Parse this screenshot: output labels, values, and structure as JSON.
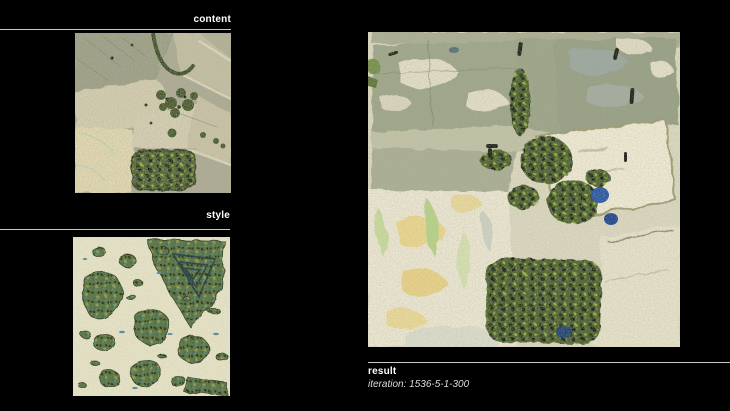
{
  "window": {
    "width": 730,
    "height": 411,
    "background": "#000000"
  },
  "sections": {
    "content": {
      "label": "content",
      "image_alt": "aerial farmland content image"
    },
    "style": {
      "label": "style",
      "image_alt": "painted map islands style image"
    },
    "result": {
      "label": "result",
      "iteration": "iteration: 1536-5-1-300",
      "image_alt": "style transfer result image"
    }
  },
  "colors": {
    "label_text": "#ffffff",
    "iteration_text": "#dcdcdc",
    "divider": "#c9c9c9",
    "content_palette": [
      "#aba990",
      "#d6cfb0",
      "#e6dcb2",
      "#3a4e1e",
      "#c4c0a3"
    ],
    "style_palette": [
      "#e9e5c8",
      "#57703d",
      "#243816",
      "#2e6b62",
      "#4a8ca6"
    ],
    "result_palette": [
      "#dfdbc2",
      "#9ba485",
      "#f4efd6",
      "#465a22",
      "#1d4fa8",
      "#f1d98b"
    ]
  }
}
